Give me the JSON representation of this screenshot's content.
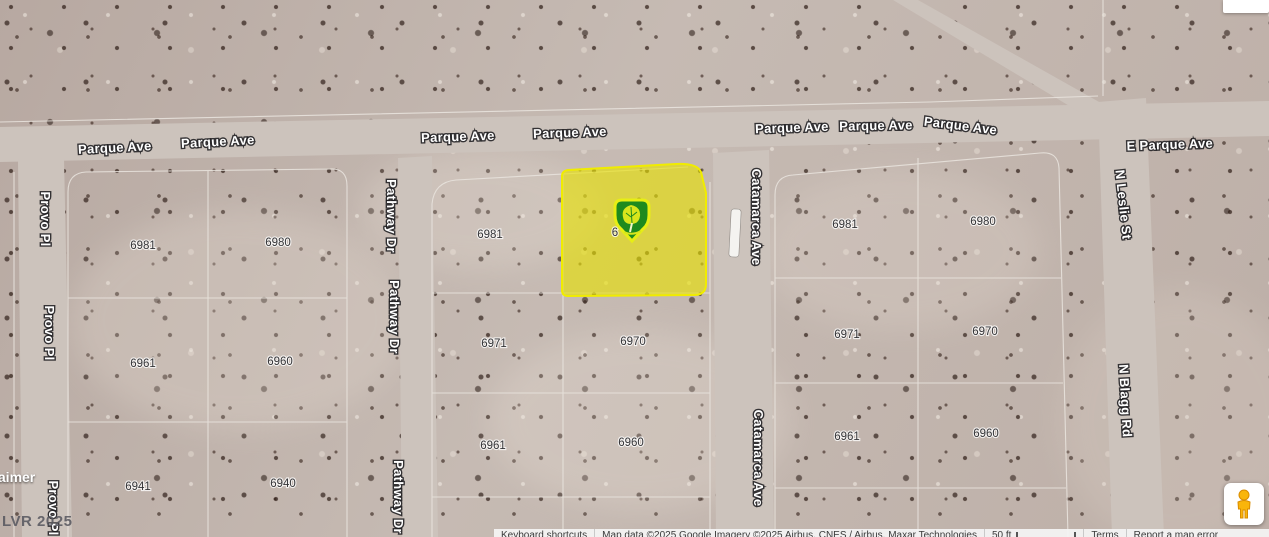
{
  "map": {
    "streets": {
      "parque": "Parque Ave",
      "e_parque": "E Parque Ave",
      "provo": "Provo Pl",
      "pathway": "Pathway Dr",
      "catamarca": "Catamarca Ave",
      "n_leslie": "N Leslie St",
      "n_blagg": "N Blagg Rd"
    },
    "parcels": {
      "left": [
        "6981",
        "6980",
        "6961",
        "6960",
        "6941",
        "6940"
      ],
      "middle": [
        "6981",
        "6971",
        "6970",
        "6961",
        "6960"
      ],
      "middle_partial": "6",
      "right": [
        "6981",
        "6980",
        "6971",
        "6970",
        "6961",
        "6960"
      ]
    },
    "selected_parcel": {
      "highlight_color": "#e8e200",
      "marker_icon": "green-tree-pin",
      "marker_fill": "#1e8a1e",
      "marker_border": "#e7ee15"
    }
  },
  "watermarks": {
    "disclaimer_fragment": "laimer",
    "lvr": "LVR 2025"
  },
  "attribution": {
    "keyboard_shortcuts": "Keyboard shortcuts",
    "map_data": "Map data ©2025 Google",
    "imagery": "Imagery ©2025 Airbus, CNES / Airbus, Maxar Technologies",
    "scale": "50 ft",
    "terms": "Terms",
    "report_error": "Report a map error"
  },
  "icons": {
    "pegman": "pegman-street-view"
  }
}
